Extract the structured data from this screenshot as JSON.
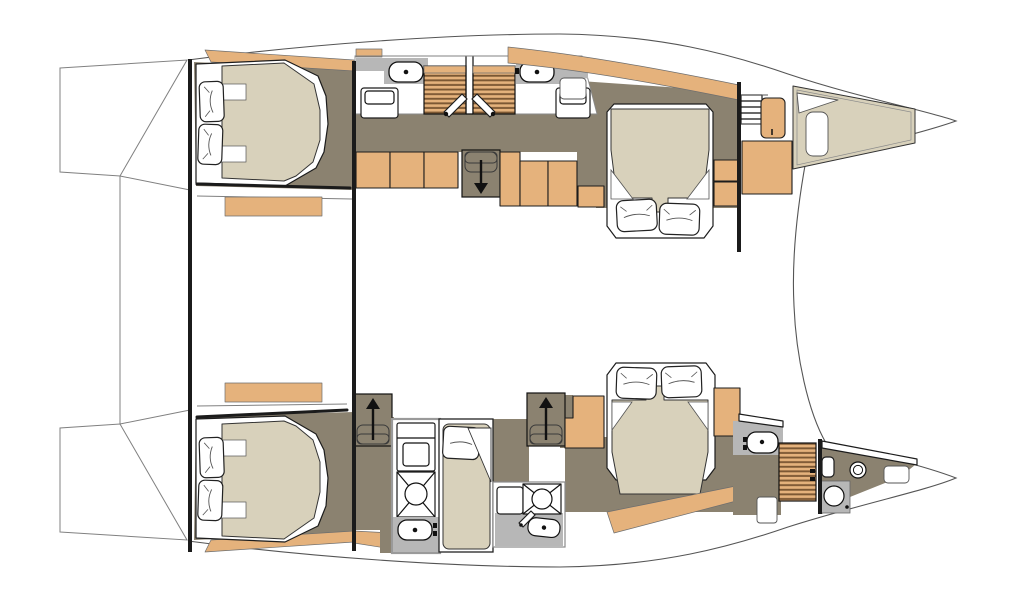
{
  "diagram": {
    "type": "floor-plan",
    "subject": "Catamaran yacht accommodation layout, plan view, bow to the right",
    "orientation": "bow-right",
    "text_labels": [],
    "hulls": [
      {
        "name": "upper-hull",
        "components": [
          {
            "name": "aft-cabin-double-bed",
            "kind": "double-bed",
            "pillows": 2
          },
          {
            "name": "aft-head-sink",
            "kind": "sink"
          },
          {
            "name": "aft-head-wc",
            "kind": "toilet"
          },
          {
            "name": "louvered-locker",
            "kind": "wardrobe",
            "count": 2
          },
          {
            "name": "fwd-head-sink",
            "kind": "sink"
          },
          {
            "name": "fwd-head-wc",
            "kind": "toilet"
          },
          {
            "name": "companionway-stairs-down",
            "kind": "stairs",
            "direction": "down"
          },
          {
            "name": "corridor-cabinets",
            "kind": "cabinet",
            "count": 6
          },
          {
            "name": "forward-cabin-double-bed",
            "kind": "double-bed",
            "pillows": 2
          },
          {
            "name": "bow-ladder",
            "kind": "ladder"
          },
          {
            "name": "bow-lockers",
            "kind": "cabinet",
            "count": 2
          },
          {
            "name": "bow-berth-platform",
            "kind": "platform"
          },
          {
            "name": "bow-hatch",
            "kind": "hatch"
          }
        ]
      },
      {
        "name": "lower-hull",
        "components": [
          {
            "name": "aft-cabin-double-bed",
            "kind": "double-bed",
            "pillows": 2
          },
          {
            "name": "companionway-stairs-up-aft",
            "kind": "stairs",
            "direction": "up"
          },
          {
            "name": "wc-unit",
            "kind": "toilet"
          },
          {
            "name": "shower-pan",
            "kind": "shower",
            "count": 2
          },
          {
            "name": "vanity-sink",
            "kind": "sink",
            "count": 2
          },
          {
            "name": "single-berth",
            "kind": "single-bed",
            "pillows": 1
          },
          {
            "name": "companionway-stairs-up-mid",
            "kind": "stairs",
            "direction": "up"
          },
          {
            "name": "forward-cabin-double-bed",
            "kind": "double-bed",
            "pillows": 2
          },
          {
            "name": "bow-head-sink",
            "kind": "sink"
          },
          {
            "name": "bow-louvered-door",
            "kind": "wardrobe"
          },
          {
            "name": "bow-head-wc",
            "kind": "toilet"
          },
          {
            "name": "bow-head-basin",
            "kind": "round-basin"
          },
          {
            "name": "bow-head-shower",
            "kind": "shower"
          }
        ]
      }
    ],
    "stern": {
      "components": [
        {
          "name": "transom-platform",
          "kind": "swim-platform",
          "count": 2
        }
      ]
    }
  },
  "palette": {
    "paper": "#ffffff",
    "wall": "#1b1b1b",
    "hairline": "#808080",
    "wood": "#e5b27c",
    "wood_slat": "#7b5733",
    "floor": "#8b8270",
    "bed_linen": "#d8d1bb",
    "counter": "#b7b7b7",
    "fixture_stroke": "#111111"
  }
}
